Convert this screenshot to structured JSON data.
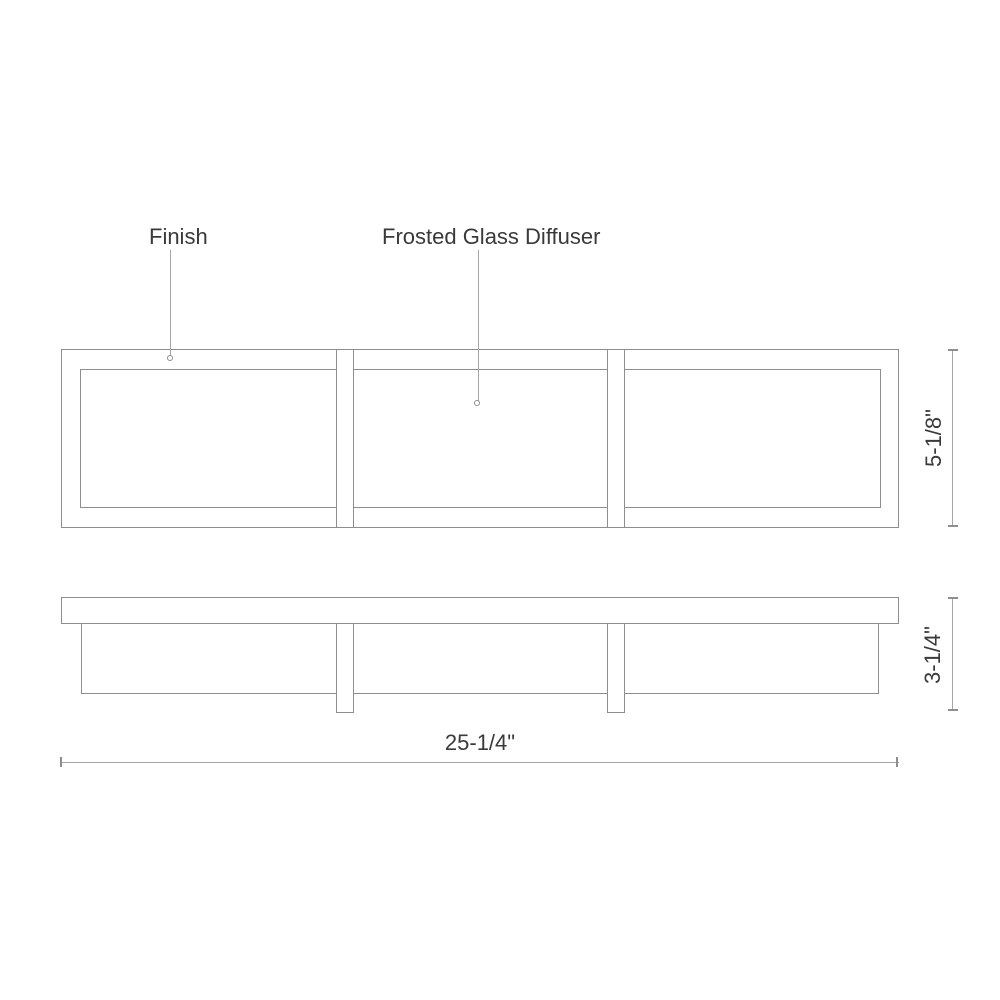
{
  "callouts": {
    "finish": "Finish",
    "diffuser": "Frosted Glass Diffuser"
  },
  "dimensions": {
    "height": "5-1/8\"",
    "depth": "3-1/4\"",
    "width": "25-1/4\""
  },
  "colors": {
    "line": "#8e8e8e",
    "dim_line": "#a6a6a6",
    "text": "#3a3a3a",
    "background": "#ffffff"
  }
}
